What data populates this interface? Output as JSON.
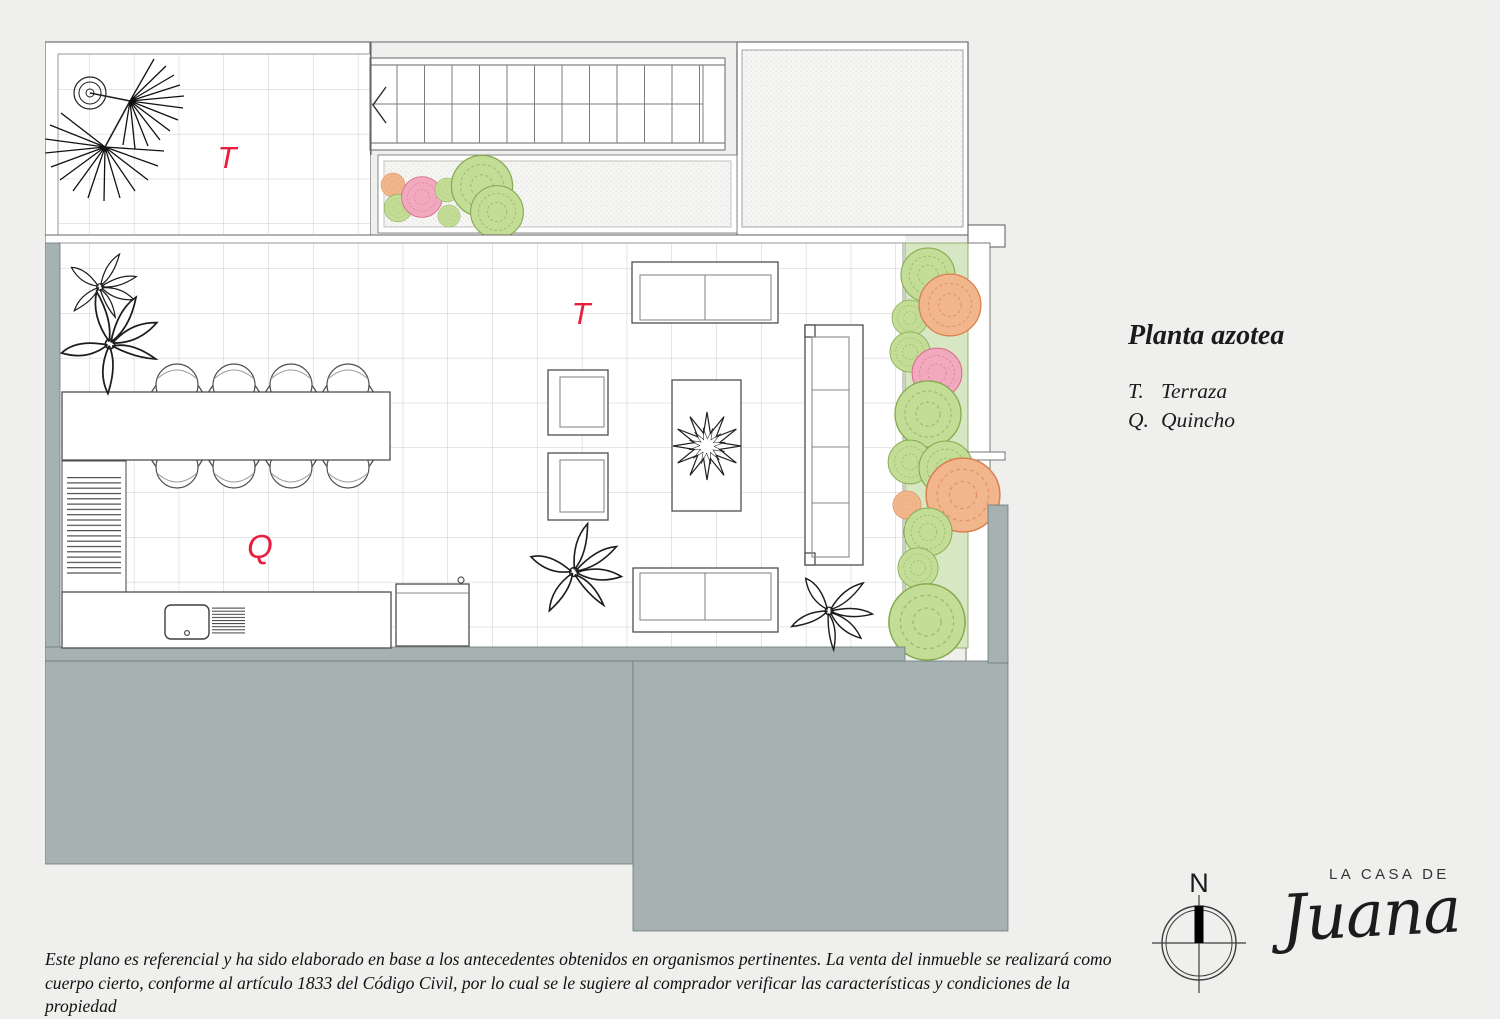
{
  "page": {
    "background": "#efefed"
  },
  "plan": {
    "zone_labels": {
      "terrace_upper": "T",
      "terrace_main": "T",
      "quincho": "Q"
    },
    "label_color": "#e81e41"
  },
  "info_panel": {
    "title": "Planta azotea",
    "legend": [
      {
        "key": "T.",
        "label": "Terraza"
      },
      {
        "key": "Q.",
        "label": "Quincho"
      }
    ]
  },
  "compass": {
    "north_label": "N"
  },
  "brand": {
    "line1": "LA CASA DE",
    "line2": "Juana"
  },
  "disclaimer": {
    "line1": "Este plano es referencial y ha sido elaborado en base a los antecedentes obtenidos en organismos pertinentes.  La venta del inmueble se realizará como",
    "line2": "cuerpo cierto, conforme al artículo 1833 del Código Civil, por lo cual se le sugiere al comprador verificar las características y condiciones de la propiedad"
  },
  "colors": {
    "roof_slab_gray": "#a6b1b2",
    "planter_green": "#d8e7c3",
    "bush_green": "#c3dc96",
    "bush_orange": "#f2b68c",
    "bush_pink": "#f0a9bd",
    "accent_red": "#e81e41"
  }
}
